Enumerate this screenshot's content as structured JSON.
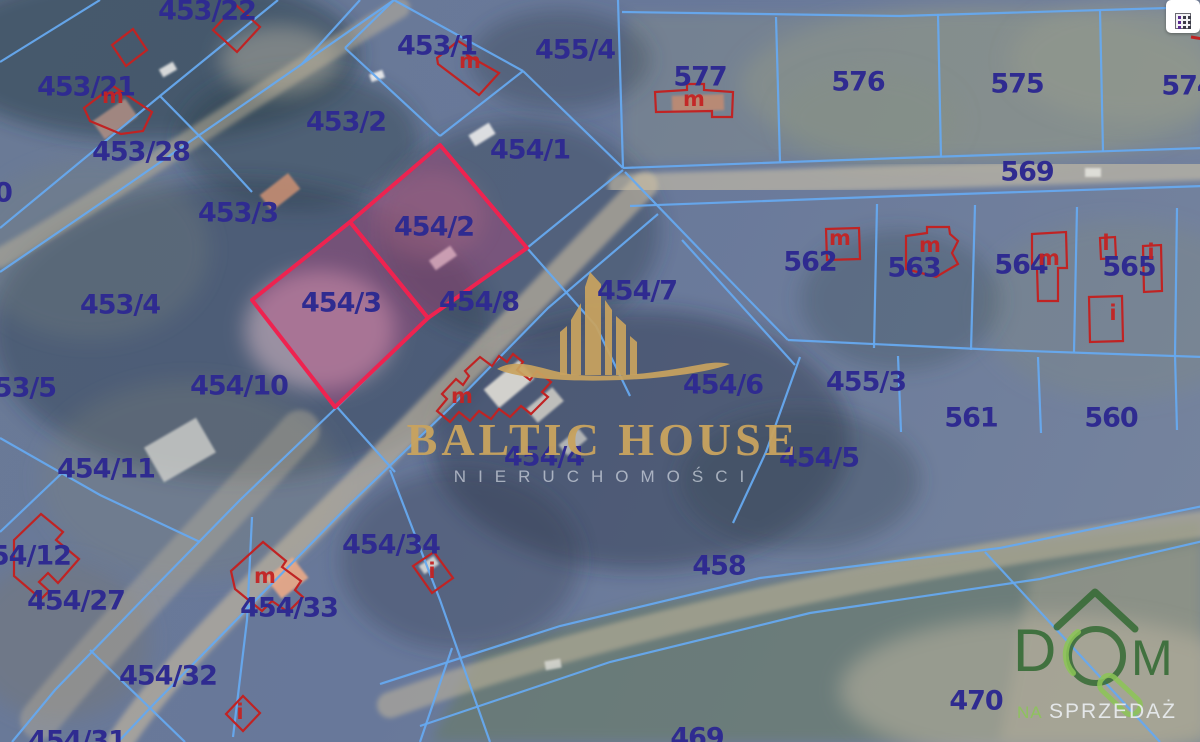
{
  "map": {
    "colors": {
      "parcel_line": "#66a9ef",
      "label": "#2f2b90",
      "highlight_stroke": "#ee2350",
      "highlight_fill": "rgba(196,62,124,0.33)",
      "building": "#c02323",
      "gold": "#c8a35f",
      "green_dark": "#2f6d33",
      "green_light": "#8cc45c"
    },
    "parcel_labels": [
      {
        "t": "453/22",
        "x": 207,
        "y": 11
      },
      {
        "t": "453/21",
        "x": 86,
        "y": 87
      },
      {
        "t": "453/28",
        "x": 141,
        "y": 152
      },
      {
        "t": "453/2",
        "x": 346,
        "y": 122
      },
      {
        "t": "453/1",
        "x": 437,
        "y": 46
      },
      {
        "t": "455/4",
        "x": 575,
        "y": 50
      },
      {
        "t": "577",
        "x": 700,
        "y": 77
      },
      {
        "t": "576",
        "x": 858,
        "y": 82
      },
      {
        "t": "575",
        "x": 1017,
        "y": 84
      },
      {
        "t": "574",
        "x": 1188,
        "y": 86
      },
      {
        "t": "569",
        "x": 1027,
        "y": 172
      },
      {
        "t": "454/1",
        "x": 530,
        "y": 150
      },
      {
        "t": "453/3",
        "x": 238,
        "y": 213
      },
      {
        "t": "454/2",
        "x": 434,
        "y": 227
      },
      {
        "t": "453/4",
        "x": 120,
        "y": 305
      },
      {
        "t": "454/3",
        "x": 341,
        "y": 303
      },
      {
        "t": "454/8",
        "x": 479,
        "y": 302
      },
      {
        "t": "454/7",
        "x": 637,
        "y": 291
      },
      {
        "t": "562",
        "x": 810,
        "y": 262
      },
      {
        "t": "563",
        "x": 914,
        "y": 268
      },
      {
        "t": "564",
        "x": 1021,
        "y": 265
      },
      {
        "t": "565",
        "x": 1129,
        "y": 267
      },
      {
        "t": "453/5",
        "x": 16,
        "y": 388
      },
      {
        "t": "454/10",
        "x": 239,
        "y": 386
      },
      {
        "t": "454/6",
        "x": 723,
        "y": 385
      },
      {
        "t": "455/3",
        "x": 866,
        "y": 382
      },
      {
        "t": "561",
        "x": 971,
        "y": 418
      },
      {
        "t": "560",
        "x": 1111,
        "y": 418
      },
      {
        "t": "454/11",
        "x": 106,
        "y": 469
      },
      {
        "t": "454/4",
        "x": 544,
        "y": 457
      },
      {
        "t": "454/5",
        "x": 819,
        "y": 458
      },
      {
        "t": "454/12",
        "x": 22,
        "y": 556
      },
      {
        "t": "454/27",
        "x": 76,
        "y": 601
      },
      {
        "t": "454/33",
        "x": 289,
        "y": 608
      },
      {
        "t": "454/34",
        "x": 391,
        "y": 545
      },
      {
        "t": "454/32",
        "x": 168,
        "y": 676
      },
      {
        "t": "458",
        "x": 719,
        "y": 566
      },
      {
        "t": "470",
        "x": 976,
        "y": 701
      },
      {
        "t": "469",
        "x": 697,
        "y": 738
      },
      {
        "t": "454/31",
        "x": 77,
        "y": 741
      },
      {
        "t": "0",
        "x": 3,
        "y": 193
      }
    ],
    "building_marks": [
      {
        "t": "m",
        "x": 470,
        "y": 61
      },
      {
        "t": "m",
        "x": 694,
        "y": 99
      },
      {
        "t": "m",
        "x": 840,
        "y": 238
      },
      {
        "t": "m",
        "x": 930,
        "y": 245
      },
      {
        "t": "m",
        "x": 1049,
        "y": 258
      },
      {
        "t": "i",
        "x": 1106,
        "y": 243
      },
      {
        "t": "i",
        "x": 1151,
        "y": 252
      },
      {
        "t": "i",
        "x": 1113,
        "y": 313
      },
      {
        "t": "m",
        "x": 265,
        "y": 576
      },
      {
        "t": "i",
        "x": 432,
        "y": 571
      },
      {
        "t": "i",
        "x": 240,
        "y": 712
      },
      {
        "t": "m",
        "x": 113,
        "y": 96
      },
      {
        "t": "m",
        "x": 462,
        "y": 396
      }
    ],
    "highlight_parcels": [
      {
        "id": "454/2",
        "points": "440,145 527,248 428,318 350,222"
      },
      {
        "id": "454/3",
        "points": "350,222 428,318 335,407 252,300"
      }
    ],
    "boundary_lines": [
      "0,62 100,0",
      "0,228 160,96 278,0",
      "0,272 120,190 302,64 394,0",
      "302,64 360,0",
      "160,96 218,155 252,192",
      "345,48 394,0",
      "394,0 523,71",
      "523,71 440,136",
      "440,136 345,48",
      "618,0 623,168",
      "523,71 623,168",
      "623,168 900,158 1203,148",
      "630,206 900,196 1203,186",
      "622,12 900,16 1203,7",
      "776,17 780,162",
      "938,14 941,157",
      "1100,10 1103,152",
      "877,204 874,348",
      "975,205 971,350",
      "1077,207 1074,352",
      "1177,208 1175,355",
      "788,340 1000,350 1203,357",
      "625,172 706,256 788,340",
      "898,356 901,432",
      "1038,357 1041,433",
      "1175,355 1177,430",
      "623,170 527,248 428,318 337,407 240,500 148,594 55,690 12,742",
      "658,214 548,308 452,406 348,506 250,606 152,706 118,742",
      "682,240 795,365",
      "800,357 766,452 733,523",
      "380,684 560,626 760,578 1000,548 1203,506",
      "420,726 610,662 810,613 1040,579 1203,541",
      "985,552 1160,742",
      "0,438 100,495 200,542",
      "62,473 0,532",
      "252,517 247,620 233,737",
      "90,650 185,742",
      "390,470 440,600 490,742",
      "337,407 395,472",
      "452,648 420,742",
      "527,248 596,326 630,396"
    ],
    "building_outlines": [
      "213,30 236,5 260,27 237,52",
      "112,45 133,29 147,50 126,66",
      "84,108 113,86 152,112 143,131 121,134 90,121",
      "437,58 458,41 471,49 467,55 499,73 479,95 438,64",
      "655,92 687,90 687,84 704,84 704,90 733,92 732,117 712,117 712,111 656,112",
      "826,229 859,228 860,259 827,260",
      "906,236 927,233 927,227 949,227 950,234 958,241 952,253 958,264 936,277 906,269",
      "1032,234 1066,232 1067,268 1058,268 1058,301 1038,301 1037,268 1032,268",
      "1100,238 1115,237 1116,258 1101,259",
      "1143,246 1161,245 1162,291 1144,292",
      "1089,297 1122,296 1123,341 1090,342",
      "14,540 41,514 63,532 56,540 79,559 58,583 48,573 39,582 49,591 41,599 14,576",
      "231,571 263,542 286,561 282,567 301,581 295,590 303,597 288,612 272,601 262,611 235,589",
      "413,566 434,552 453,578 432,593",
      "226,714 243,696 260,713 243,731",
      "437,411 447,399 442,394 456,379 463,385 469,376 465,371 480,357 492,366 499,356 507,362 513,354 523,362 517,370 530,380 537,371 551,382 542,392 548,397 531,414 521,406 510,417 499,409 491,419 479,411 470,421 459,412 450,422 437,411"
    ],
    "red_lines": [
      "1191,37 1203,39"
    ],
    "skyline": {
      "towers": [
        "560,375 560,332 567,326 567,375",
        "571,375 571,320 581,303 581,375",
        "585,375 585,287 590,272 601,284 601,375",
        "605,375 605,300 612,310 612,375",
        "616,375 616,316 626,325 626,375",
        "630,375 630,336 637,342 637,375"
      ],
      "swoosh": "M497,369 C520,355 548,373 578,375 C625,378 665,371 698,365 C712,362 722,362 730,364 C712,371 672,378 622,380 C572,382 518,379 497,369 Z"
    },
    "terrain": {
      "fields": [
        {
          "points": "430,742 480,650 640,605 900,558 1203,518 1203,742",
          "c": "rgba(104,124,98,0.60)"
        },
        {
          "points": "623,165 1203,148 1203,12 628,14",
          "c": "rgba(140,146,130,0.35)"
        },
        {
          "points": "1000,742 1030,575 1203,540 1203,742",
          "c": "rgba(175,168,150,0.45)"
        }
      ],
      "ellipses": [
        {
          "cx": 150,
          "cy": 55,
          "rx": 210,
          "ry": 85,
          "c": "rgba(38,56,66,0.50)"
        },
        {
          "cx": 300,
          "cy": 140,
          "rx": 120,
          "ry": 70,
          "c": "rgba(46,64,76,0.45)"
        },
        {
          "cx": 240,
          "cy": 330,
          "rx": 250,
          "ry": 150,
          "c": "rgba(40,54,74,0.42)"
        },
        {
          "cx": 90,
          "cy": 250,
          "rx": 120,
          "ry": 90,
          "c": "rgba(120,130,125,0.30)"
        },
        {
          "cx": 520,
          "cy": 230,
          "rx": 140,
          "ry": 110,
          "c": "rgba(44,60,80,0.40)"
        },
        {
          "cx": 640,
          "cy": 440,
          "rx": 210,
          "ry": 130,
          "c": "rgba(34,50,66,0.42)"
        },
        {
          "cx": 980,
          "cy": 85,
          "rx": 240,
          "ry": 80,
          "c": "rgba(148,152,136,0.45)"
        },
        {
          "cx": 1130,
          "cy": 60,
          "rx": 120,
          "ry": 60,
          "c": "rgba(155,158,140,0.40)"
        },
        {
          "cx": 870,
          "cy": 120,
          "rx": 90,
          "ry": 50,
          "c": "rgba(135,142,128,0.35)"
        },
        {
          "cx": 1120,
          "cy": 310,
          "rx": 140,
          "ry": 90,
          "c": "rgba(130,140,126,0.30)"
        },
        {
          "cx": 900,
          "cy": 300,
          "rx": 100,
          "ry": 70,
          "c": "rgba(60,76,88,0.35)"
        },
        {
          "cx": 460,
          "cy": 560,
          "rx": 120,
          "ry": 90,
          "c": "rgba(50,64,80,0.35)"
        },
        {
          "cx": 190,
          "cy": 480,
          "rx": 150,
          "ry": 100,
          "c": "rgba(125,130,120,0.28)"
        },
        {
          "cx": 1050,
          "cy": 690,
          "rx": 210,
          "ry": 75,
          "c": "rgba(186,178,160,0.55)"
        },
        {
          "cx": 320,
          "cy": 330,
          "rx": 75,
          "ry": 60,
          "c": "rgba(216,186,196,0.55)"
        },
        {
          "cx": 430,
          "cy": 215,
          "rx": 55,
          "ry": 45,
          "c": "rgba(150,125,135,0.40)"
        },
        {
          "cx": 60,
          "cy": 640,
          "rx": 90,
          "ry": 80,
          "c": "rgba(120,118,105,0.35)"
        },
        {
          "cx": 280,
          "cy": 60,
          "rx": 60,
          "ry": 35,
          "c": "rgba(190,185,165,0.45)"
        },
        {
          "cx": 800,
          "cy": 480,
          "rx": 120,
          "ry": 70,
          "c": "rgba(55,70,80,0.35)"
        },
        {
          "cx": 560,
          "cy": 60,
          "rx": 90,
          "ry": 50,
          "c": "rgba(52,68,82,0.40)"
        }
      ],
      "roads": [
        {
          "d": "M645,185 C560,270 450,390 340,500 C230,610 160,680 120,742",
          "w": 26,
          "c": "rgba(199,186,160,0.62)"
        },
        {
          "d": "M620,186 L1203,168",
          "w": 24,
          "c": "rgba(205,193,166,0.60)"
        },
        {
          "d": "M0,258 C120,190 260,90 400,8",
          "w": 20,
          "c": "rgba(194,182,156,0.50)"
        },
        {
          "d": "M390,705 C600,630 900,562 1203,524",
          "w": 26,
          "c": "rgba(195,182,154,0.55)"
        },
        {
          "d": "M300,430 C220,520 120,620 40,720",
          "w": 40,
          "c": "rgba(200,186,158,0.35)"
        }
      ],
      "quads": [
        {
          "x": 262,
          "y": 182,
          "w": 36,
          "h": 20,
          "r": -38,
          "c": "rgba(205,145,115,0.85)"
        },
        {
          "x": 672,
          "y": 95,
          "w": 52,
          "h": 16,
          "r": -2,
          "c": "rgba(200,140,110,0.80)"
        },
        {
          "x": 470,
          "y": 128,
          "w": 24,
          "h": 13,
          "r": -32,
          "c": "rgba(235,235,235,0.90)"
        },
        {
          "x": 430,
          "y": 252,
          "w": 26,
          "h": 12,
          "r": -35,
          "c": "rgba(225,225,220,0.85)"
        },
        {
          "x": 486,
          "y": 372,
          "w": 46,
          "h": 24,
          "r": -40,
          "c": "rgba(225,222,215,0.90)"
        },
        {
          "x": 528,
          "y": 396,
          "w": 34,
          "h": 18,
          "r": -40,
          "c": "rgba(210,208,200,0.85)"
        },
        {
          "x": 560,
          "y": 435,
          "w": 26,
          "h": 14,
          "r": -40,
          "c": "rgba(200,200,195,0.80)"
        },
        {
          "x": 95,
          "y": 108,
          "w": 40,
          "h": 22,
          "r": -35,
          "c": "rgba(190,150,135,0.75)"
        },
        {
          "x": 160,
          "y": 65,
          "w": 16,
          "h": 9,
          "r": -30,
          "c": "rgba(230,230,228,0.90)"
        },
        {
          "x": 420,
          "y": 560,
          "w": 18,
          "h": 10,
          "r": -35,
          "c": "rgba(225,225,220,0.85)"
        },
        {
          "x": 1085,
          "y": 168,
          "w": 16,
          "h": 9,
          "r": 0,
          "c": "rgba(230,230,225,0.85)"
        },
        {
          "x": 370,
          "y": 72,
          "w": 14,
          "h": 8,
          "r": -20,
          "c": "rgba(240,240,240,0.90)"
        },
        {
          "x": 545,
          "y": 660,
          "w": 16,
          "h": 9,
          "r": -10,
          "c": "rgba(220,220,215,0.80)"
        },
        {
          "x": 270,
          "y": 565,
          "w": 34,
          "h": 26,
          "r": -38,
          "c": "rgba(235,170,135,0.90)"
        },
        {
          "x": 150,
          "y": 430,
          "w": 60,
          "h": 40,
          "r": -30,
          "c": "rgba(215,215,210,0.75)"
        }
      ]
    },
    "watermark_center": {
      "title": "BALTIC HOUSE",
      "subtitle": "NIERUCHOMOŚCI"
    },
    "watermark_corner": {
      "word": "DOM",
      "tagline_highlight": "NA",
      "tagline": "SPRZEDAŻ"
    }
  }
}
